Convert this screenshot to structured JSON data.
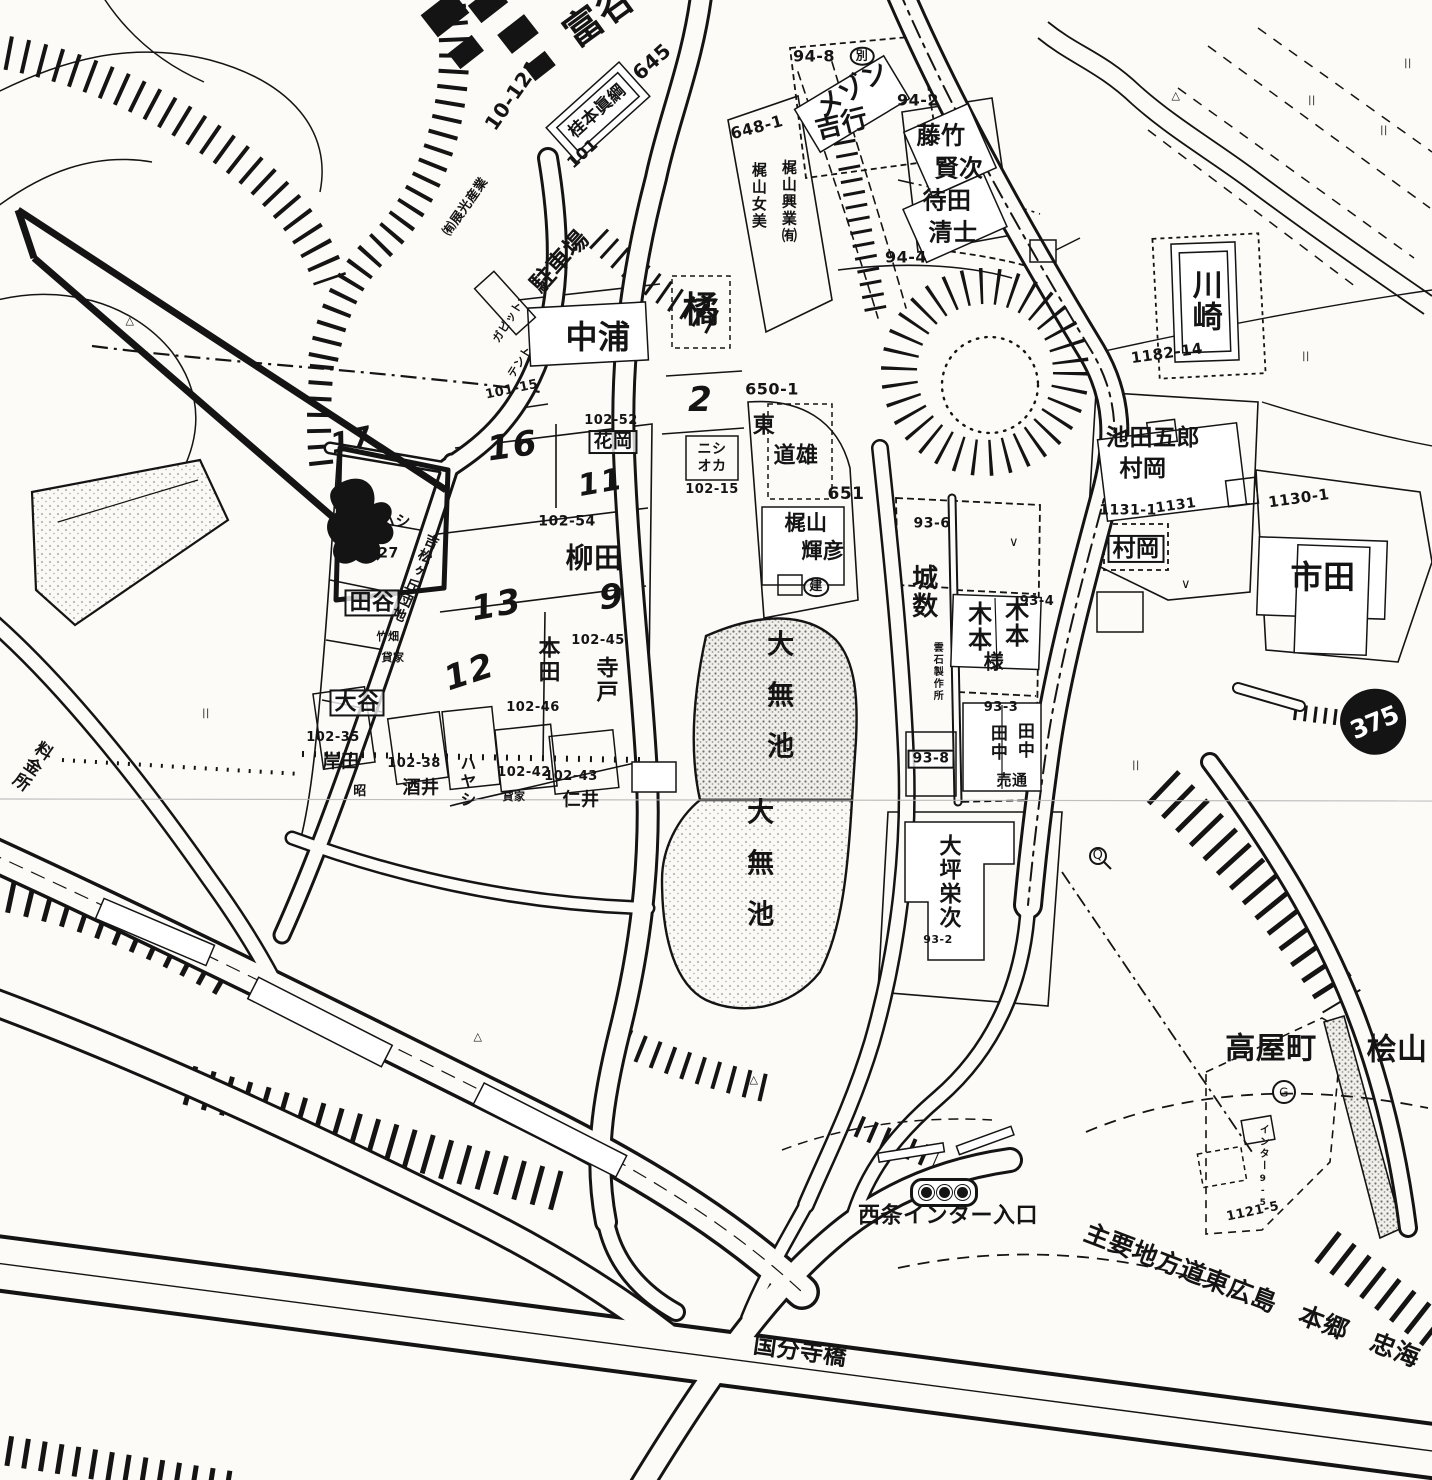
{
  "colors": {
    "background": "#fcfbf8",
    "ink": "#141414",
    "pond_speckle": "#7a7a7a",
    "seam": "#b5b5b5"
  },
  "map": {
    "route_shield": "375",
    "labels": [
      {
        "text": "富谷",
        "x": 600,
        "y": 16,
        "s": 38,
        "r": -36
      },
      {
        "text": "10-121",
        "x": 513,
        "y": 95,
        "s": 20,
        "r": -55
      },
      {
        "text": "㈲展光産業",
        "x": 466,
        "y": 207,
        "s": 13,
        "r": -55
      },
      {
        "text": "645",
        "x": 652,
        "y": 62,
        "s": 20,
        "r": -42
      },
      {
        "text": "桂本眞綱",
        "x": 598,
        "y": 112,
        "s": 17,
        "r": -42
      },
      {
        "text": "101",
        "x": 583,
        "y": 154,
        "s": 16,
        "r": -42
      },
      {
        "text": "駐車場",
        "x": 560,
        "y": 262,
        "s": 24,
        "r": -48
      },
      {
        "text": "ガピット",
        "x": 508,
        "y": 322,
        "s": 11,
        "r": -58
      },
      {
        "text": "テント",
        "x": 520,
        "y": 362,
        "s": 11,
        "r": -58
      },
      {
        "text": "101-15",
        "x": 512,
        "y": 390,
        "s": 13,
        "r": -12
      },
      {
        "text": "94-8",
        "x": 814,
        "y": 57,
        "s": 16
      },
      {
        "text": "別",
        "x": 862,
        "y": 56,
        "s": 12,
        "c": "circle"
      },
      {
        "text": "メゾン",
        "x": 853,
        "y": 90,
        "s": 26,
        "r": -33
      },
      {
        "text": "吉行",
        "x": 842,
        "y": 125,
        "s": 26,
        "r": -14
      },
      {
        "text": "94-2",
        "x": 918,
        "y": 101,
        "s": 16
      },
      {
        "text": "藤竹",
        "x": 941,
        "y": 136,
        "s": 24
      },
      {
        "text": "賢次",
        "x": 959,
        "y": 169,
        "s": 24
      },
      {
        "text": "待田",
        "x": 947,
        "y": 201,
        "s": 24
      },
      {
        "text": "清士",
        "x": 953,
        "y": 233,
        "s": 24
      },
      {
        "text": "94-4",
        "x": 906,
        "y": 258,
        "s": 16
      },
      {
        "text": "648-1",
        "x": 757,
        "y": 128,
        "s": 16,
        "r": -15
      },
      {
        "text": "梶山女美",
        "x": 758,
        "y": 196,
        "s": 15,
        "v": 1
      },
      {
        "text": "梶山興業㈲",
        "x": 788,
        "y": 202,
        "s": 15,
        "v": 1
      },
      {
        "text": "中浦",
        "x": 598,
        "y": 338,
        "s": 32
      },
      {
        "text": "橘",
        "x": 701,
        "y": 311,
        "s": 36
      },
      {
        "text": "2",
        "x": 701,
        "y": 401,
        "s": 34,
        "c": "hand"
      },
      {
        "text": "ニシ",
        "x": 712,
        "y": 450,
        "s": 14
      },
      {
        "text": "オカ",
        "x": 712,
        "y": 467,
        "s": 14
      },
      {
        "text": "102-15",
        "x": 712,
        "y": 490,
        "s": 13
      },
      {
        "text": "102-52",
        "x": 611,
        "y": 421,
        "s": 13
      },
      {
        "text": "花岡",
        "x": 613,
        "y": 442,
        "s": 19,
        "c": "box"
      },
      {
        "text": "16",
        "x": 513,
        "y": 447,
        "s": 34,
        "r": -8,
        "c": "hand"
      },
      {
        "text": "11",
        "x": 601,
        "y": 483,
        "s": 30,
        "r": -10,
        "c": "hand"
      },
      {
        "text": "17",
        "x": 352,
        "y": 440,
        "s": 28,
        "r": -12,
        "c": "hand"
      },
      {
        "text": "ヨコハシ",
        "x": 380,
        "y": 522,
        "s": 15
      },
      {
        "text": "102-27",
        "x": 370,
        "y": 554,
        "s": 14
      },
      {
        "text": "102-54",
        "x": 567,
        "y": 522,
        "s": 14
      },
      {
        "text": "柳田",
        "x": 594,
        "y": 558,
        "s": 28
      },
      {
        "text": "13",
        "x": 497,
        "y": 606,
        "s": 34,
        "r": -10,
        "c": "hand"
      },
      {
        "text": "9",
        "x": 612,
        "y": 598,
        "s": 34,
        "r": -5,
        "c": "hand"
      },
      {
        "text": "12",
        "x": 470,
        "y": 673,
        "s": 34,
        "r": -18,
        "c": "hand"
      },
      {
        "text": "田谷",
        "x": 372,
        "y": 603,
        "s": 22,
        "c": "box"
      },
      {
        "text": "竹畑",
        "x": 388,
        "y": 637,
        "s": 11
      },
      {
        "text": "貸家",
        "x": 393,
        "y": 658,
        "s": 11
      },
      {
        "text": "大谷",
        "x": 357,
        "y": 703,
        "s": 22,
        "c": "box"
      },
      {
        "text": "吉松ヶ丘団地",
        "x": 414,
        "y": 578,
        "s": 14,
        "v": 1,
        "r": 24
      },
      {
        "text": "本田",
        "x": 547,
        "y": 660,
        "s": 22,
        "v": 1
      },
      {
        "text": "102-46",
        "x": 533,
        "y": 708,
        "s": 13
      },
      {
        "text": "102-45",
        "x": 598,
        "y": 641,
        "s": 13
      },
      {
        "text": "寺戸",
        "x": 605,
        "y": 680,
        "s": 22,
        "v": 1
      },
      {
        "text": "102-35",
        "x": 333,
        "y": 738,
        "s": 13
      },
      {
        "text": "岸田",
        "x": 341,
        "y": 763,
        "s": 18
      },
      {
        "text": "昭",
        "x": 360,
        "y": 792,
        "s": 13
      },
      {
        "text": "102-38",
        "x": 414,
        "y": 764,
        "s": 13
      },
      {
        "text": "酒井",
        "x": 421,
        "y": 789,
        "s": 18
      },
      {
        "text": "ハヤシ",
        "x": 466,
        "y": 782,
        "s": 16,
        "v": 1
      },
      {
        "text": "102-42",
        "x": 524,
        "y": 773,
        "s": 13
      },
      {
        "text": "貸家",
        "x": 514,
        "y": 797,
        "s": 11
      },
      {
        "text": "102-43",
        "x": 571,
        "y": 777,
        "s": 13
      },
      {
        "text": "仁井",
        "x": 581,
        "y": 801,
        "s": 18
      },
      {
        "text": "650-1",
        "x": 772,
        "y": 390,
        "s": 16
      },
      {
        "text": "東",
        "x": 764,
        "y": 426,
        "s": 22
      },
      {
        "text": "道雄",
        "x": 796,
        "y": 456,
        "s": 22
      },
      {
        "text": "651",
        "x": 846,
        "y": 495,
        "s": 17
      },
      {
        "text": "梶山",
        "x": 806,
        "y": 523,
        "s": 21
      },
      {
        "text": "輝彦",
        "x": 823,
        "y": 551,
        "s": 21
      },
      {
        "text": "建",
        "x": 816,
        "y": 587,
        "s": 13,
        "c": "circle"
      },
      {
        "text": "大無池",
        "x": 777,
        "y": 706,
        "s": 27,
        "v": 1,
        "c": "spread"
      },
      {
        "text": "大無池",
        "x": 757,
        "y": 874,
        "s": 27,
        "v": 1,
        "c": "spread"
      },
      {
        "text": "93-6",
        "x": 932,
        "y": 524,
        "s": 14
      },
      {
        "text": "城数",
        "x": 922,
        "y": 592,
        "s": 26,
        "v": 1
      },
      {
        "text": "雲石製作所",
        "x": 936,
        "y": 672,
        "s": 10,
        "v": 1
      },
      {
        "text": "93-4",
        "x": 1037,
        "y": 602,
        "s": 13
      },
      {
        "text": "木本",
        "x": 977,
        "y": 627,
        "s": 24,
        "v": 1
      },
      {
        "text": "木本",
        "x": 1014,
        "y": 623,
        "s": 24,
        "v": 1
      },
      {
        "text": "様",
        "x": 994,
        "y": 662,
        "s": 20
      },
      {
        "text": "93-3",
        "x": 1001,
        "y": 708,
        "s": 13
      },
      {
        "text": "田中",
        "x": 996,
        "y": 743,
        "s": 17,
        "v": 1
      },
      {
        "text": "田中",
        "x": 1023,
        "y": 741,
        "s": 17,
        "v": 1
      },
      {
        "text": "売通",
        "x": 1012,
        "y": 781,
        "s": 15
      },
      {
        "text": "93-8",
        "x": 931,
        "y": 759,
        "s": 14,
        "c": "box"
      },
      {
        "text": "大坪栄次",
        "x": 948,
        "y": 882,
        "s": 22,
        "v": 1
      },
      {
        "text": "93-2",
        "x": 938,
        "y": 940,
        "s": 11
      },
      {
        "text": "川崎",
        "x": 1204,
        "y": 301,
        "s": 30,
        "v": 1
      },
      {
        "text": "1182-14",
        "x": 1167,
        "y": 354,
        "s": 15,
        "r": -8
      },
      {
        "text": "池田五郎",
        "x": 1153,
        "y": 438,
        "s": 23
      },
      {
        "text": "村岡",
        "x": 1143,
        "y": 469,
        "s": 23
      },
      {
        "text": "1131-1",
        "x": 1128,
        "y": 511,
        "s": 14
      },
      {
        "text": "1131",
        "x": 1176,
        "y": 506,
        "s": 14,
        "r": -8
      },
      {
        "text": "村岡",
        "x": 1136,
        "y": 549,
        "s": 23,
        "c": "box"
      },
      {
        "text": "1130-1",
        "x": 1299,
        "y": 499,
        "s": 15,
        "r": -8
      },
      {
        "text": "市田",
        "x": 1323,
        "y": 578,
        "s": 32
      },
      {
        "text": "料金所",
        "x": 30,
        "y": 765,
        "s": 17,
        "v": 1,
        "r": 35
      },
      {
        "text": "高屋町",
        "x": 1271,
        "y": 1049,
        "s": 30
      },
      {
        "text": "桧山",
        "x": 1397,
        "y": 1050,
        "s": 30
      },
      {
        "text": "インター",
        "x": 1262,
        "y": 1148,
        "s": 10,
        "v": 1
      },
      {
        "text": "9-5",
        "x": 1262,
        "y": 1192,
        "s": 9,
        "v": 1
      },
      {
        "text": "1121-5",
        "x": 1253,
        "y": 1212,
        "s": 13,
        "r": -12
      },
      {
        "text": "西条インター入口",
        "x": 948,
        "y": 1216,
        "s": 22
      },
      {
        "text": "主要地方道東広島　本郷　忠海",
        "x": 1252,
        "y": 1296,
        "s": 25,
        "r": 21
      },
      {
        "text": "国分寺橋",
        "x": 800,
        "y": 1352,
        "s": 23,
        "r": 8
      },
      {
        "text": "G",
        "x": 1284,
        "y": 1093,
        "s": 12,
        "c": "mark"
      },
      {
        "text": "Q",
        "x": 1098,
        "y": 856,
        "s": 13,
        "c": "mark"
      },
      {
        "text": "△",
        "x": 1176,
        "y": 96,
        "s": 11,
        "c": "mark"
      },
      {
        "text": "△",
        "x": 478,
        "y": 1037,
        "s": 11,
        "c": "mark"
      },
      {
        "text": "△",
        "x": 754,
        "y": 1080,
        "s": 11,
        "c": "mark"
      },
      {
        "text": "△",
        "x": 130,
        "y": 321,
        "s": 11,
        "c": "mark"
      },
      {
        "text": "||",
        "x": 1312,
        "y": 101,
        "s": 10,
        "c": "mark"
      },
      {
        "text": "||",
        "x": 1384,
        "y": 131,
        "s": 10,
        "c": "mark"
      },
      {
        "text": "||",
        "x": 1306,
        "y": 357,
        "s": 10,
        "c": "mark"
      },
      {
        "text": "||",
        "x": 1408,
        "y": 64,
        "s": 10,
        "c": "mark"
      },
      {
        "text": "||",
        "x": 1136,
        "y": 766,
        "s": 10,
        "c": "mark"
      },
      {
        "text": "||",
        "x": 206,
        "y": 714,
        "s": 10,
        "c": "mark"
      },
      {
        "text": "∨",
        "x": 1014,
        "y": 543,
        "s": 13,
        "c": "mark"
      },
      {
        "text": "∨",
        "x": 1186,
        "y": 585,
        "s": 13,
        "c": "mark"
      }
    ]
  }
}
